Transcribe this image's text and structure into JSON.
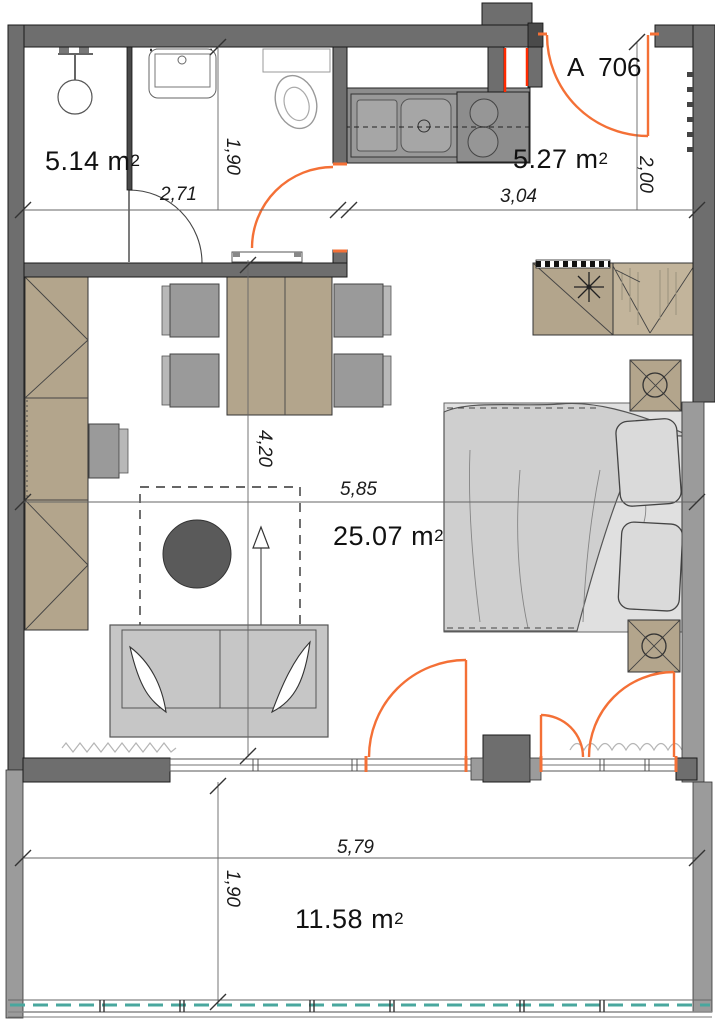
{
  "apartment": {
    "label": "A 706"
  },
  "rooms": {
    "bathroom": {
      "value": "5.14 m",
      "sup": "2"
    },
    "kitchen": {
      "value": "5.27 m",
      "sup": "2"
    },
    "living": {
      "value": "25.07 m",
      "sup": "2"
    },
    "balcony": {
      "value": "11.58 m",
      "sup": "2"
    }
  },
  "dimensions": {
    "bath_width": "2,71",
    "bath_depth": "1,90",
    "kitchen_width": "3,04",
    "entry_depth": "2,00",
    "living_depth": "4,20",
    "living_width": "5,85",
    "balcony_width": "5,79",
    "balcony_depth": "1,90"
  },
  "colors": {
    "wall": "#6e6e6e",
    "wall_light": "#9b9b9b",
    "tan": "#b3a58c",
    "tan_light": "#c2b49b",
    "gray": "#9a9a9a",
    "sofa": "#c6c6c6",
    "orange": "#f47036",
    "red": "#ff2a00",
    "teal": "#49a79e"
  }
}
